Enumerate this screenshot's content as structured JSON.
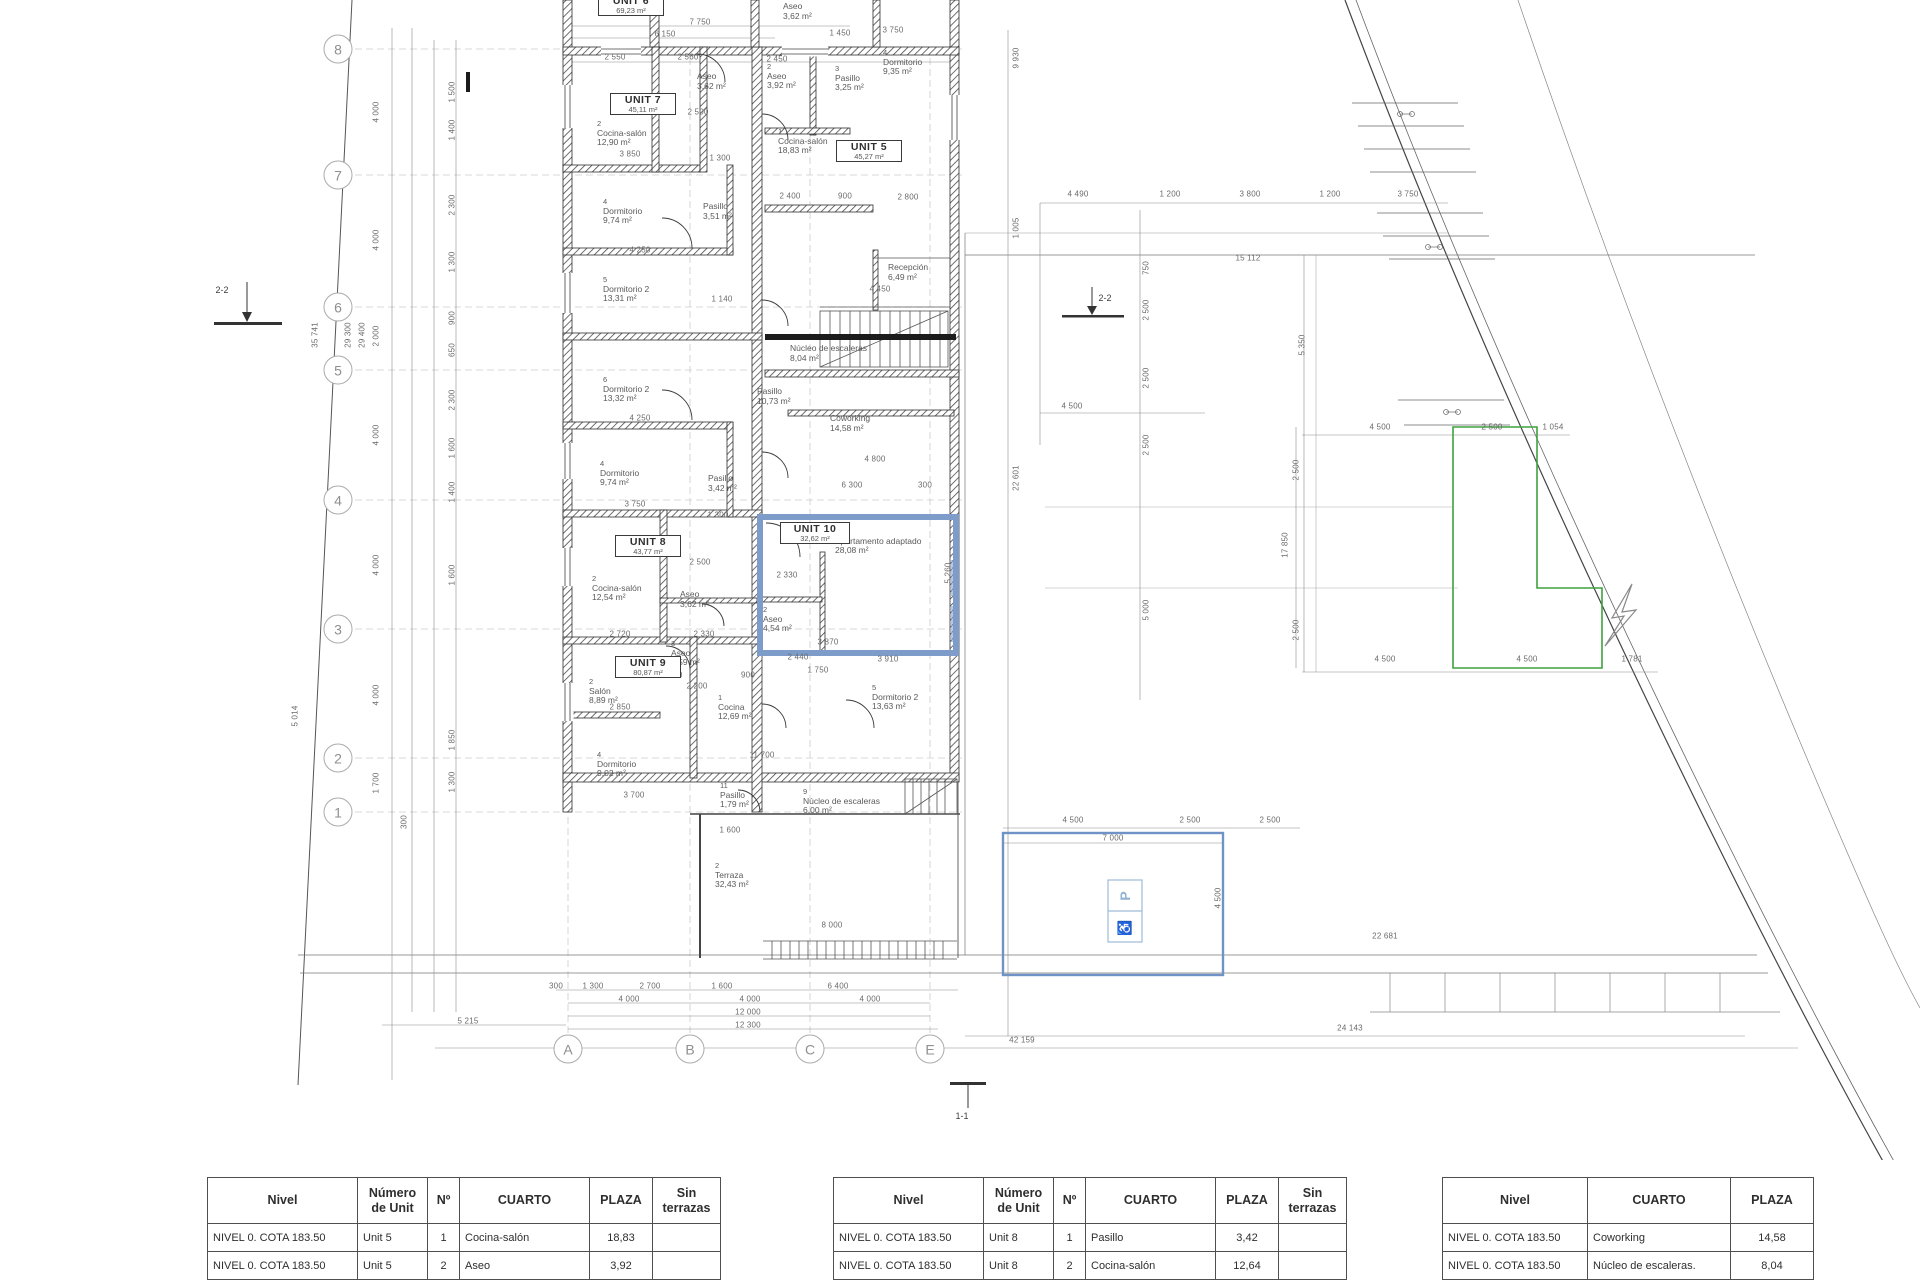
{
  "plan": {
    "grid_rows": [
      [
        "8",
        49
      ],
      [
        "7",
        175
      ],
      [
        "6",
        307
      ],
      [
        "5",
        370
      ],
      [
        "4",
        500
      ],
      [
        "3",
        629
      ],
      [
        "2",
        758
      ],
      [
        "1",
        812
      ]
    ],
    "grid_cols": [
      [
        "A",
        568
      ],
      [
        "B",
        690
      ],
      [
        "C",
        810
      ],
      [
        "E",
        930
      ]
    ],
    "section_markers": [
      [
        "2-2",
        222,
        290
      ],
      [
        "2-2",
        1105,
        298
      ],
      [
        "1-1",
        962,
        1116
      ]
    ],
    "unit_boxes": [
      [
        "UNIT 6",
        "69,23 m²",
        598,
        -6,
        56
      ],
      [
        "UNIT 7",
        "45,11 m²",
        610,
        93,
        56
      ],
      [
        "UNIT 5",
        "45,27 m²",
        836,
        140,
        56
      ],
      [
        "UNIT 8",
        "43,77 m²",
        615,
        535,
        56
      ],
      [
        "UNIT 10",
        "32,62 m²",
        780,
        522,
        60
      ],
      [
        "UNIT 9",
        "80,87 m²",
        615,
        656,
        56
      ]
    ],
    "rooms": [
      [
        "",
        "Aseo",
        "3,62 m²",
        697,
        72
      ],
      [
        "",
        "Aseo",
        "3,62 m²",
        783,
        2
      ],
      [
        "2",
        "Cocina-salón",
        "12,90 m²",
        597,
        120
      ],
      [
        "4",
        "Dormitorio",
        "9,74 m²",
        603,
        198
      ],
      [
        "",
        "Pasillo",
        "3,51 m²",
        703,
        202
      ],
      [
        "5",
        "Dormitorio 2",
        "13,31 m²",
        603,
        276
      ],
      [
        "6",
        "Dormitorio 2",
        "13,32 m²",
        603,
        376
      ],
      [
        "4",
        "Dormitorio",
        "9,74 m²",
        600,
        460
      ],
      [
        "",
        "Pasillo",
        "3,42 m²",
        708,
        474
      ],
      [
        "2",
        "Cocina-salón",
        "12,54 m²",
        592,
        575
      ],
      [
        "",
        "Aseo",
        "3,62 m²",
        680,
        590
      ],
      [
        "3",
        "Aseo",
        "3,59 m²",
        671,
        640
      ],
      [
        "2",
        "Salón",
        "8,89 m²",
        589,
        678
      ],
      [
        "4",
        "Dormitorio",
        "9,02 m²",
        597,
        751
      ],
      [
        "1",
        "Cocina",
        "12,69 m²",
        718,
        694
      ],
      [
        "11",
        "Pasillo",
        "1,79 m²",
        720,
        782
      ],
      [
        "2",
        "Terraza",
        "32,43 m²",
        715,
        862
      ],
      [
        "2",
        "Aseo",
        "3,92 m²",
        767,
        63
      ],
      [
        "3",
        "Pasillo",
        "3,25 m²",
        835,
        65
      ],
      [
        "4",
        "Dormitorio",
        "9,35 m²",
        883,
        49
      ],
      [
        "1",
        "Cocina-salón",
        "18,83 m²",
        778,
        128
      ],
      [
        "",
        "Recepción",
        "6,49 m²",
        888,
        263
      ],
      [
        "",
        "Núcleo de escaleras",
        "8,04 m²",
        790,
        344
      ],
      [
        "",
        "Pasillo",
        "10,73 m²",
        757,
        387
      ],
      [
        "",
        "Coworking",
        "14,58 m²",
        830,
        414
      ],
      [
        "1",
        "Apartamento adaptado",
        "28,08 m²",
        835,
        528
      ],
      [
        "2",
        "Aseo",
        "4,54 m²",
        763,
        606
      ],
      [
        "5",
        "Dormitorio 2",
        "13,63 m²",
        872,
        684
      ],
      [
        "9",
        "Núcleo de escaleras",
        "6,00 m²",
        803,
        788
      ]
    ],
    "dims_h": [
      [
        "7 750",
        700,
        22
      ],
      [
        "6 150",
        665,
        34
      ],
      [
        "2 550",
        615,
        57
      ],
      [
        "2 560",
        688,
        57
      ],
      [
        "2 450",
        777,
        59
      ],
      [
        "1 450",
        840,
        33
      ],
      [
        "3 750",
        893,
        30
      ],
      [
        "2 500",
        698,
        112
      ],
      [
        "3 850",
        630,
        154
      ],
      [
        "1 300",
        720,
        158
      ],
      [
        "4 250",
        640,
        250
      ],
      [
        "1 140",
        722,
        299
      ],
      [
        "4 450",
        880,
        289
      ],
      [
        "4 250",
        640,
        418
      ],
      [
        "4 800",
        875,
        459
      ],
      [
        "3 750",
        635,
        504
      ],
      [
        "1 300",
        718,
        515
      ],
      [
        "6 300",
        852,
        485
      ],
      [
        "300",
        925,
        485
      ],
      [
        "2 500",
        700,
        562
      ],
      [
        "2 330",
        787,
        575
      ],
      [
        "2 720",
        620,
        634
      ],
      [
        "2 330",
        704,
        634
      ],
      [
        "2 440",
        798,
        657
      ],
      [
        "3 910",
        888,
        659
      ],
      [
        "3 870",
        828,
        642
      ],
      [
        "1 000",
        672,
        675
      ],
      [
        "2 200",
        697,
        686
      ],
      [
        "900",
        748,
        675
      ],
      [
        "2 850",
        620,
        707
      ],
      [
        "11 700",
        762,
        755
      ],
      [
        "3 700",
        634,
        795
      ],
      [
        "1 600",
        730,
        830
      ],
      [
        "8 000",
        832,
        925
      ],
      [
        "2 400",
        790,
        196
      ],
      [
        "900",
        845,
        196
      ],
      [
        "2 800",
        908,
        197
      ],
      [
        "1 750",
        818,
        670
      ],
      [
        "300",
        556,
        986
      ],
      [
        "1 300",
        593,
        986
      ],
      [
        "2 700",
        650,
        986
      ],
      [
        "1 600",
        722,
        986
      ],
      [
        "6 400",
        838,
        986
      ],
      [
        "4 000",
        629,
        999
      ],
      [
        "4 000",
        750,
        999
      ],
      [
        "4 000",
        870,
        999
      ],
      [
        "12 000",
        748,
        1012
      ],
      [
        "12 300",
        748,
        1025
      ],
      [
        "5 215",
        468,
        1021
      ],
      [
        "42 159",
        1022,
        1040
      ],
      [
        "24 143",
        1350,
        1028
      ],
      [
        "22 681",
        1385,
        936
      ],
      [
        "4 490",
        1078,
        194
      ],
      [
        "1 200",
        1170,
        194
      ],
      [
        "3 800",
        1250,
        194
      ],
      [
        "1 200",
        1330,
        194
      ],
      [
        "3 750",
        1408,
        194
      ],
      [
        "15 112",
        1248,
        258
      ],
      [
        "4 500",
        1072,
        406
      ],
      [
        "4 500",
        1380,
        427
      ],
      [
        "2 500",
        1492,
        427
      ],
      [
        "1 054",
        1553,
        427
      ],
      [
        "4 500",
        1385,
        659
      ],
      [
        "4 500",
        1527,
        659
      ],
      [
        "1 781",
        1632,
        659
      ],
      [
        "4 500",
        1073,
        820
      ],
      [
        "2 500",
        1190,
        820
      ],
      [
        "2 500",
        1270,
        820
      ],
      [
        "7 000",
        1113,
        838
      ]
    ],
    "dims_v": [
      [
        "4 000",
        376,
        112
      ],
      [
        "4 000",
        376,
        240
      ],
      [
        "2 000",
        376,
        336
      ],
      [
        "4 000",
        376,
        435
      ],
      [
        "4 000",
        376,
        565
      ],
      [
        "4 000",
        376,
        695
      ],
      [
        "1 700",
        376,
        783
      ],
      [
        "300",
        404,
        822
      ],
      [
        "35 741",
        315,
        335
      ],
      [
        "29 300",
        348,
        335
      ],
      [
        "29 400",
        362,
        335
      ],
      [
        "5 014",
        295,
        716
      ],
      [
        "1 500",
        452,
        92
      ],
      [
        "1 400",
        452,
        130
      ],
      [
        "2 300",
        452,
        205
      ],
      [
        "1 300",
        452,
        262
      ],
      [
        "900",
        452,
        318
      ],
      [
        "650",
        452,
        350
      ],
      [
        "2 300",
        452,
        400
      ],
      [
        "1 600",
        452,
        448
      ],
      [
        "1 400",
        452,
        492
      ],
      [
        "1 600",
        452,
        575
      ],
      [
        "1 850",
        452,
        740
      ],
      [
        "1 300",
        452,
        782
      ],
      [
        "9 930",
        1016,
        58
      ],
      [
        "1 005",
        1016,
        228
      ],
      [
        "22 601",
        1016,
        478
      ],
      [
        "5 260",
        948,
        573
      ],
      [
        "750",
        1146,
        268
      ],
      [
        "2 500",
        1146,
        310
      ],
      [
        "2 500",
        1146,
        378
      ],
      [
        "2 500",
        1146,
        445
      ],
      [
        "5 000",
        1146,
        610
      ],
      [
        "5 350",
        1302,
        345
      ],
      [
        "2 500",
        1296,
        470
      ],
      [
        "17 850",
        1285,
        545
      ],
      [
        "2 500",
        1296,
        630
      ],
      [
        "4 500",
        1218,
        898
      ]
    ],
    "icons": {
      "parking": "P",
      "accessible": "♿"
    },
    "colors": {
      "wall": "#2f2f2f",
      "unit10_highlight": "#7e9cc9",
      "green_plot": "#3da23d",
      "accessible_blue": "#6f93c4",
      "dim": "#8a8a8a"
    }
  },
  "tables": [
    {
      "x": 207,
      "col_widths": [
        150,
        70,
        32,
        130,
        63,
        68
      ],
      "headers": [
        "Nivel",
        "Número de Unit",
        "Nº",
        "CUARTO",
        "PLAZA",
        "Sin terrazas"
      ],
      "align": [
        "l",
        "l",
        "c",
        "l",
        "c",
        "c"
      ],
      "rows": [
        [
          "NIVEL 0. COTA 183.50",
          "Unit 5",
          "1",
          "Cocina-salón",
          "18,83",
          ""
        ],
        [
          "NIVEL 0. COTA 183.50",
          "Unit 5",
          "2",
          "Aseo",
          "3,92",
          ""
        ],
        [
          "",
          "",
          "",
          "",
          "",
          ""
        ]
      ]
    },
    {
      "x": 833,
      "col_widths": [
        150,
        70,
        32,
        130,
        63,
        68
      ],
      "headers": [
        "Nivel",
        "Número de Unit",
        "Nº",
        "CUARTO",
        "PLAZA",
        "Sin terrazas"
      ],
      "align": [
        "l",
        "l",
        "c",
        "l",
        "c",
        "c"
      ],
      "rows": [
        [
          "NIVEL 0. COTA 183.50",
          "Unit 8",
          "1",
          "Pasillo",
          "3,42",
          ""
        ],
        [
          "NIVEL 0. COTA 183.50",
          "Unit 8",
          "2",
          "Cocina-salón",
          "12,64",
          ""
        ],
        [
          "",
          "",
          "",
          "",
          "",
          ""
        ]
      ]
    },
    {
      "x": 1442,
      "col_widths": [
        145,
        143,
        83
      ],
      "headers": [
        "Nivel",
        "CUARTO",
        "PLAZA"
      ],
      "align": [
        "l",
        "l",
        "c"
      ],
      "rows": [
        [
          "NIVEL 0. COTA 183.50",
          "Coworking",
          "14,58"
        ],
        [
          "NIVEL 0. COTA 183.50",
          "Núcleo de escaleras.",
          "8,04"
        ],
        [
          "",
          "",
          ""
        ]
      ]
    }
  ]
}
